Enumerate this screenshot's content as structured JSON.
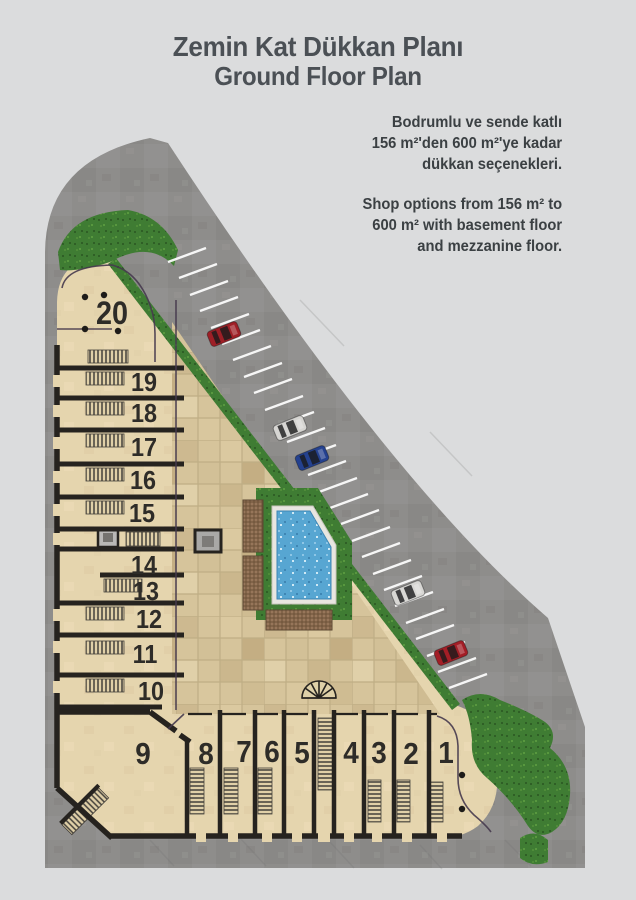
{
  "title": {
    "line1": "Zemin Kat Dükkan Planı",
    "line2": "Ground Floor Plan"
  },
  "description": {
    "tr": [
      "Bodrumlu ve sende katlı",
      "156 m²'den 600 m²'ye kadar",
      "dükkan seçenekleri."
    ],
    "en": [
      "Shop options from 156 m² to",
      "600 m² with basement floor",
      "and  mezzanine floor."
    ]
  },
  "plan": {
    "left_shops": [
      "20",
      "19",
      "18",
      "17",
      "16",
      "15",
      "14",
      "13",
      "12",
      "11",
      "10"
    ],
    "bottom_shops": [
      "9",
      "8",
      "7",
      "6",
      "5",
      "4",
      "3",
      "2",
      "1"
    ],
    "cars": [
      {
        "name": "car-red-upper",
        "color": "#9e1f26"
      },
      {
        "name": "car-silver-upper",
        "color": "#d6d5d2"
      },
      {
        "name": "car-blue",
        "color": "#24418f"
      },
      {
        "name": "car-silver-lower",
        "color": "#d8d7d4"
      },
      {
        "name": "car-red-lower",
        "color": "#a31e26"
      }
    ],
    "colors": {
      "road": "#8e8d8b",
      "sand": "#e5d5ae",
      "paver": "#d3c199",
      "grass": "#3f7c33",
      "water": "#57a6d2",
      "wall": "#26231f",
      "accent": "#463a4e",
      "stripe": "#ffffff",
      "number": "#2e2c28"
    }
  }
}
